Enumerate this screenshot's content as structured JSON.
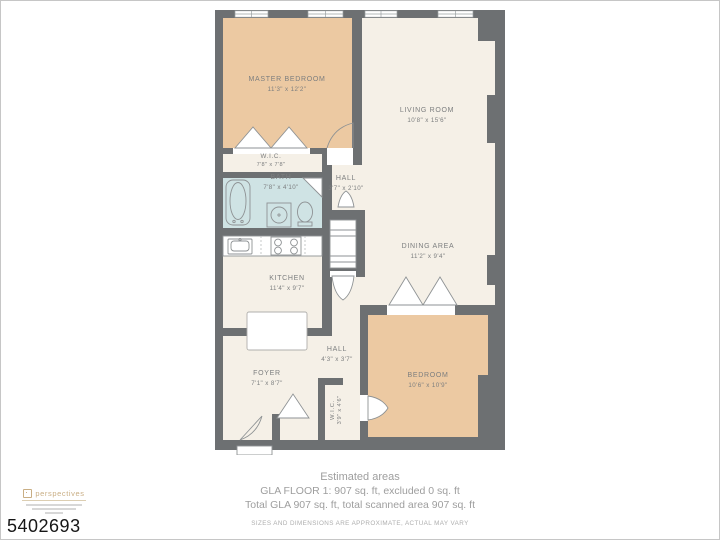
{
  "floorplan": {
    "colors": {
      "wall": "#6d7072",
      "cream": "#f5f0e7",
      "tan": "#ecc9a2",
      "blue": "#cfe3e4",
      "label": "#7c7e7f"
    },
    "rooms": [
      {
        "id": "master-bedroom",
        "name": "MASTER BEDROOM",
        "dims": "11'3\" x 12'2\""
      },
      {
        "id": "wic-upper",
        "name": "W.I.C.",
        "dims": "7'8\" x 7'8\""
      },
      {
        "id": "bath",
        "name": "BATH",
        "dims": "7'8\" x 4'10\""
      },
      {
        "id": "hall-upper",
        "name": "HALL",
        "dims": "3'7\" x 2'10\""
      },
      {
        "id": "living-room",
        "name": "LIVING ROOM",
        "dims": "10'8\" x 15'6\""
      },
      {
        "id": "kitchen",
        "name": "KITCHEN",
        "dims": "11'4\" x 9'7\""
      },
      {
        "id": "dining-area",
        "name": "DINING AREA",
        "dims": "11'2\" x 9'4\""
      },
      {
        "id": "foyer",
        "name": "FOYER",
        "dims": "7'1\" x 8'7\""
      },
      {
        "id": "hall-lower",
        "name": "HALL",
        "dims": "4'3\" x 3'7\""
      },
      {
        "id": "bedroom",
        "name": "BEDROOM",
        "dims": "10'6\" x 10'9\""
      },
      {
        "id": "wic-lower",
        "name": "W.I.C.",
        "dims": "3'9\" x 4'6\""
      }
    ]
  },
  "footer": {
    "title": "Estimated areas",
    "line1": "GLA FLOOR 1: 907 sq. ft, excluded 0 sq. ft",
    "line2": "Total GLA 907 sq. ft, total scanned area 907 sq. ft",
    "disclaimer": "SIZES AND DIMENSIONS ARE APPROXIMATE, ACTUAL MAY VARY"
  },
  "branding": {
    "logo_text": "perspectives",
    "photo_id": "5402693"
  }
}
